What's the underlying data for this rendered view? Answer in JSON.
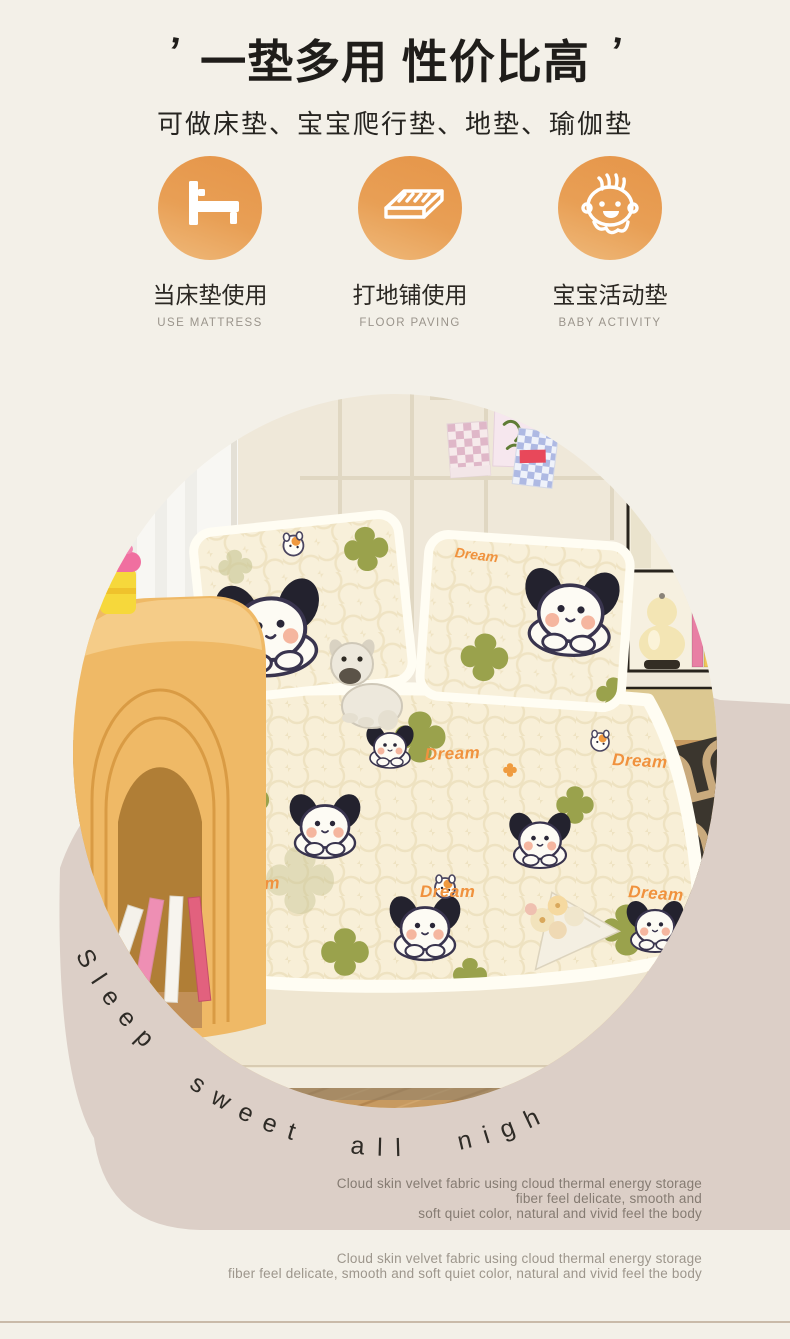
{
  "header": {
    "quote_left": "’",
    "title": "一垫多用 性价比高",
    "quote_right": "’",
    "subtitle": "可做床垫、宝宝爬行垫、地垫、瑜伽垫"
  },
  "features": [
    {
      "icon": "bed-icon",
      "label": "当床垫使用",
      "sublabel": "USE MATTRESS"
    },
    {
      "icon": "floor-mattress-icon",
      "label": "打地铺使用",
      "sublabel": "FLOOR PAVING"
    },
    {
      "icon": "baby-icon",
      "label": "宝宝活动垫",
      "sublabel": "BABY ACTIVITY"
    }
  ],
  "hero": {
    "curved_text": "Sleep sweet all night~",
    "pattern_word": "Dream"
  },
  "descriptions": [
    {
      "line1": "Cloud skin velvet fabric using cloud thermal energy storage",
      "line2": "fiber feel delicate, smooth and",
      "line3": "soft quiet color, natural and vivid feel the body"
    },
    {
      "line1": "Cloud skin velvet fabric using cloud thermal energy storage",
      "line2": "fiber feel delicate, smooth and soft quiet color, natural and vivid feel the body"
    }
  ],
  "colors": {
    "background": "#F3F0E8",
    "accent_orange": "#E89A4B",
    "ring_pink": "#DCCFC7",
    "star_green": "#9AA24C",
    "dream_orange": "#F0923E"
  }
}
